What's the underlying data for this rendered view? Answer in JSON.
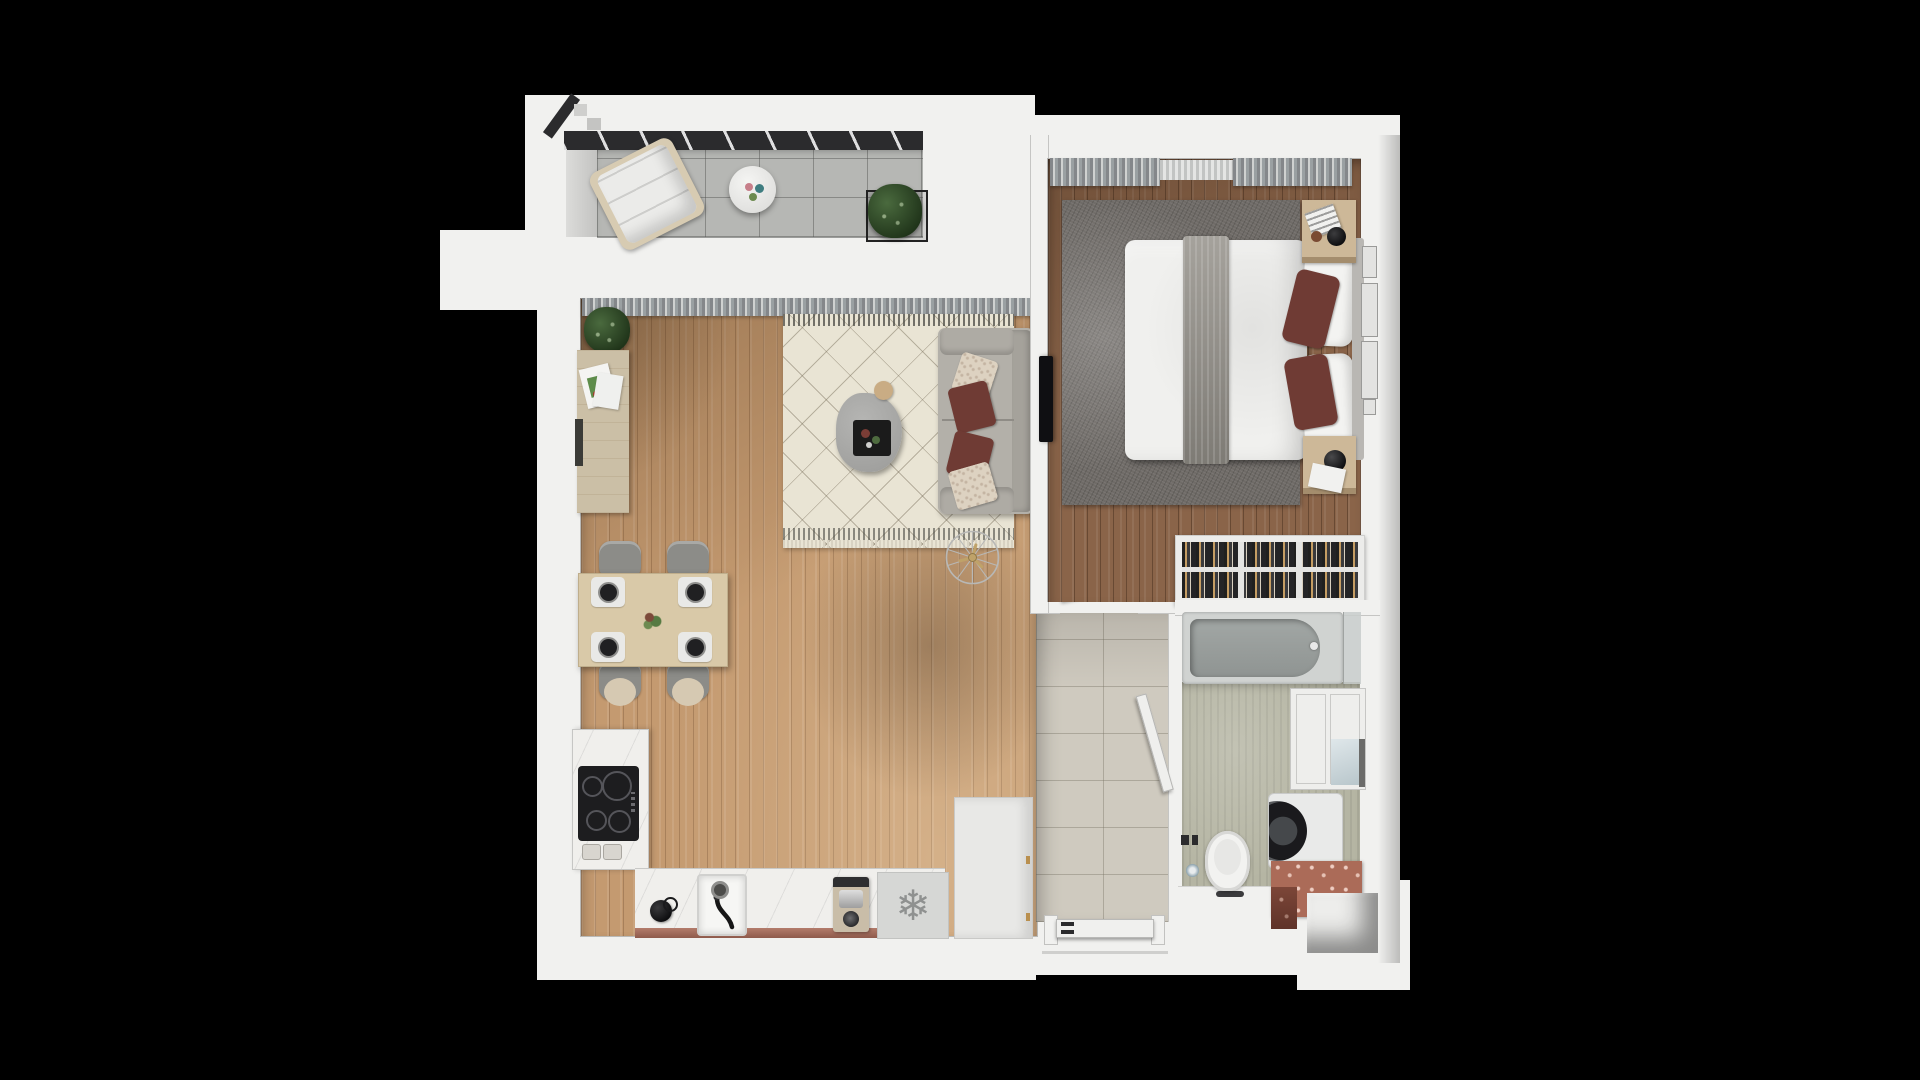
{
  "scene": {
    "kind": "apartment-floor-plan-3d-top-view",
    "background": "black letterbox around a white-walled one-bedroom apartment render",
    "rooms": [
      {
        "name": "balcony",
        "floor": "grey concrete tiles",
        "items": [
          "glass balustrade",
          "lounge chair",
          "round side table",
          "three cups",
          "potted plant"
        ]
      },
      {
        "name": "living-room",
        "floor": "light oak planks",
        "items": [
          "window curtains",
          "potted plant",
          "wooden sideboard",
          "art prints",
          "berber rug",
          "two-seat sofa",
          "cream patterned pillows",
          "maroon pillows",
          "stone coffee table",
          "black serving tray",
          "side stool",
          "ceiling fan",
          "dining table for four",
          "place settings",
          "centerpiece plant"
        ]
      },
      {
        "name": "kitchen",
        "floor": "light oak planks",
        "items": [
          "induction cooktop",
          "control knobs",
          "marble worktop",
          "basin sink",
          "black faucet",
          "kettle",
          "espresso machine",
          "freezer compartment",
          "tall entry cabinet"
        ]
      },
      {
        "name": "hallway",
        "floor": "beige ceramic tiles",
        "items": [
          "entrance door",
          "bedroom door",
          "bathroom door"
        ]
      },
      {
        "name": "bedroom",
        "floor": "walnut planks",
        "items": [
          "blackout curtains",
          "sheer curtain",
          "grey shag rug",
          "double bed",
          "white duvet",
          "striped runner blanket",
          "white pillows",
          "maroon cushions",
          "nightstand with magazine and vase",
          "nightstand with sphere lamp",
          "wall tv",
          "leaning art frames",
          "built-in wardrobe with hangers"
        ]
      },
      {
        "name": "bathroom",
        "floor": "green concrete",
        "items": [
          "bathtub",
          "chrome mixer",
          "glass screen",
          "wall-hung toilet",
          "flush plates",
          "toilet paper roll",
          "washing machine",
          "terracotta counter",
          "wall cabinet",
          "recessed lightwell"
        ]
      }
    ]
  },
  "palette": {
    "bg": "#000000",
    "wall": "#f1f1ef",
    "line": "#c7c7c5",
    "woodL": "#c49a70",
    "woodB": "#8a6449",
    "tileB": "#b6b7b4",
    "tileH": "#cfcabf",
    "bathF": "#b5b5a3",
    "rugC": "#e9e4d4",
    "rugG": "#6f6b67",
    "sofa": "#b3b0a9",
    "maroon": "#6f3b34",
    "cream": "#ddd2c1",
    "tableW": "#d9c9a8",
    "sideb": "#cbbfa6",
    "marble": "#f0efec",
    "terra": "#ab6b58",
    "cooktop": "#1d1d1f",
    "fridge": "#d6d7d5",
    "closet": "#1a1a1d",
    "hanger": "#c59d63",
    "tub": "#9aa09e",
    "curtain": "#8f9190",
    "glass": "#2b2b2d",
    "green": "#3c5a33",
    "gold": "#bfa269",
    "snow": "#8f9190"
  },
  "icons": {
    "freezer_symbol": "❄"
  }
}
